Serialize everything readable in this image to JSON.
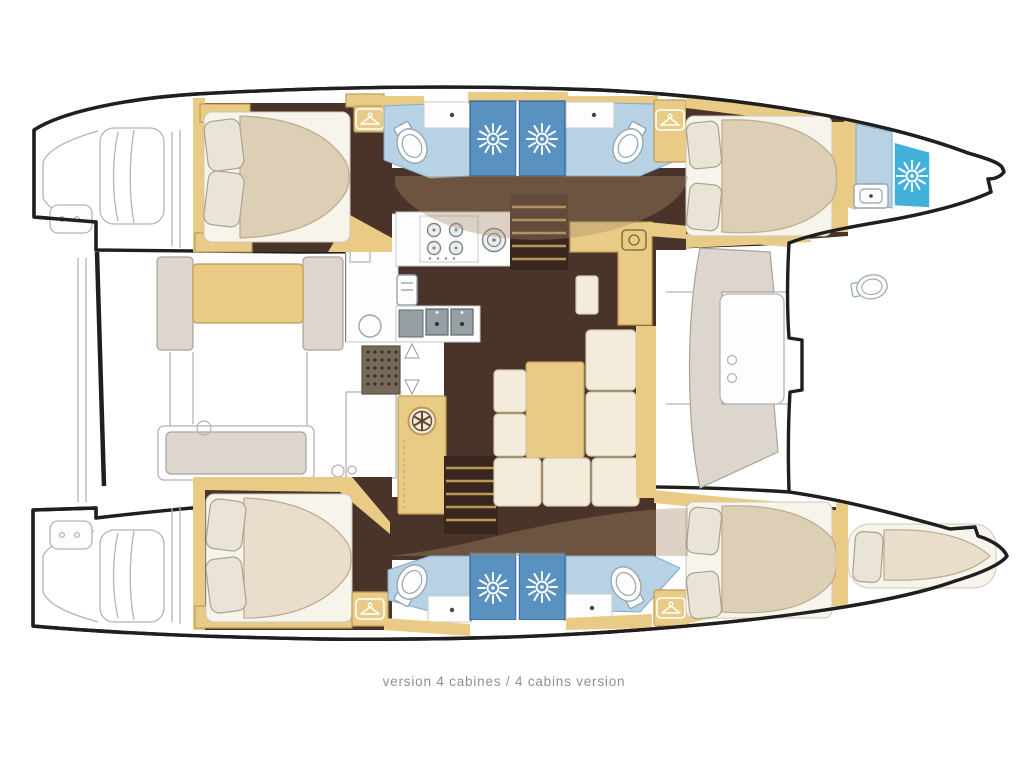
{
  "caption": "version 4 cabines / 4 cabins version",
  "palette": {
    "outline": "#1f1f1f",
    "thin_line": "#b4b4b4",
    "floor": "#4a3429",
    "floor_dark": "#38261f",
    "wood": "#e9cb85",
    "wood_edge": "#bd9b55",
    "bed_base": "#f7f4ec",
    "mattress": "#dccfb5",
    "mattress_edge": "#bfae90",
    "mattress_light": "#e8decb",
    "pillow": "#eae4d7",
    "pillow_edge": "#a9a190",
    "cushion": "#f3ecda",
    "cushion_edge": "#d6caae",
    "gray_seat": "#dcd6ce",
    "gray_seat_edge": "#aaa298",
    "bath_floor": "#b7d2e5",
    "bath_edge": "#85aac6",
    "shower": "#5992c1",
    "shower_edge": "#38648f",
    "shower_bow": "#41b1db",
    "white": "#ffffff",
    "fixture_edge": "#97a6b0",
    "steel": "#97a1a5",
    "steel_dark": "#5f686c",
    "grate": "#77695a",
    "grate_dot": "#3a312a",
    "overlay": "#a88a68",
    "caption_color": "#8f8f8f"
  },
  "icons": {
    "sunburst-icon": "shower head",
    "hanger-icon": "wardrobe / hanging locker",
    "fan-icon": "ventilation hatch",
    "stove-icon": "4-burner stove",
    "toilet-icon": "toilet",
    "sink-icon": "sink",
    "arrow-icon": "companionway direction arrow"
  },
  "plan": {
    "vessel_type": "catamaran",
    "view": "top-down interior floor plan",
    "cabin_count": 4,
    "cabins": [
      {
        "position": "port aft",
        "features": [
          "double bed",
          "pillows",
          "wardrobe"
        ]
      },
      {
        "position": "port forward",
        "features": [
          "double bed",
          "pillows",
          "wardrobe"
        ]
      },
      {
        "position": "starboard aft",
        "features": [
          "double bed",
          "pillows",
          "wardrobe"
        ]
      },
      {
        "position": "starboard forward",
        "features": [
          "double bed",
          "pillows",
          "wardrobe"
        ]
      }
    ],
    "bathrooms": [
      {
        "position": "port aft",
        "fixtures": [
          "toilet",
          "sink",
          "shower"
        ]
      },
      {
        "position": "port forward",
        "fixtures": [
          "toilet",
          "sink",
          "shower"
        ]
      },
      {
        "position": "starboard aft",
        "fixtures": [
          "toilet",
          "sink",
          "shower"
        ]
      },
      {
        "position": "starboard forward",
        "fixtures": [
          "toilet",
          "sink",
          "shower"
        ]
      },
      {
        "position": "port bow",
        "fixtures": [
          "toilet",
          "sink",
          "shower"
        ]
      }
    ],
    "salon": [
      "galley 4-burner stove",
      "round burner",
      "oven",
      "double sink",
      "fridge",
      "floor grate",
      "vent cabinet",
      "two companionway stairs",
      "dining table",
      "U-shaped sofa",
      "nav cabinet"
    ],
    "exterior": [
      "stern swim platforms",
      "aft cockpit bench and table",
      "forward cockpit curved bench with table",
      "bow sunpad berth"
    ]
  }
}
